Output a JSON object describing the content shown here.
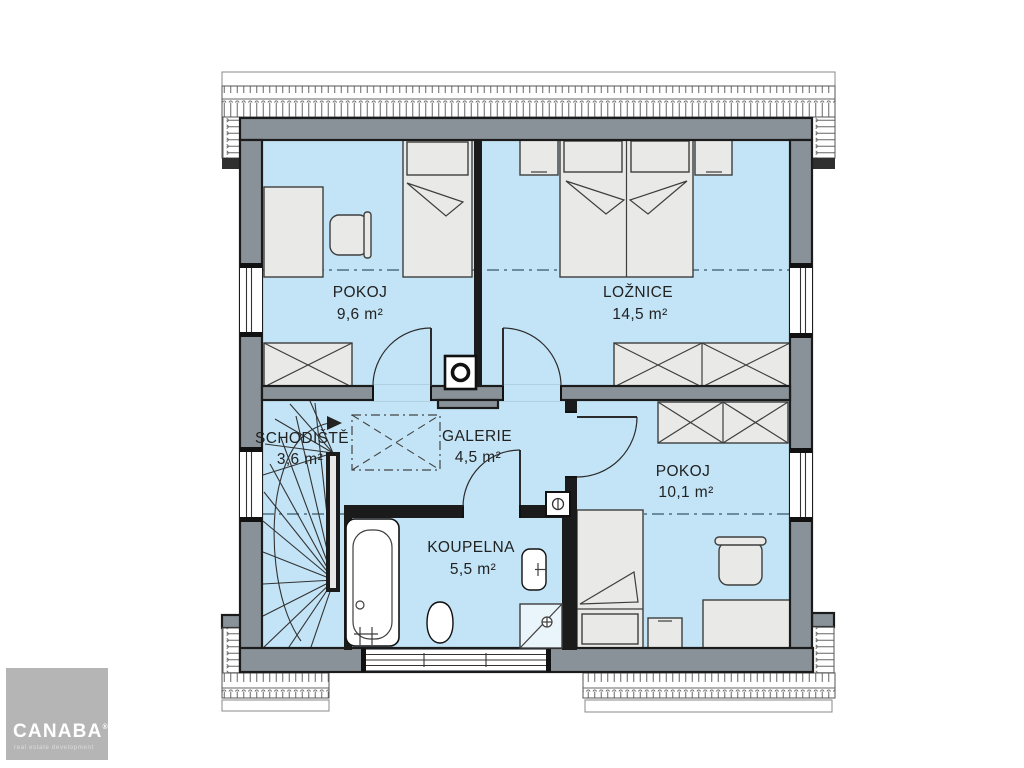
{
  "plan": {
    "rooms": [
      {
        "id": "pokoj-upper",
        "name": "POKOJ",
        "area": "9,6 m²"
      },
      {
        "id": "loznice",
        "name": "LOŽNICE",
        "area": "14,5 m²"
      },
      {
        "id": "schodiste",
        "name": "SCHODIŠTĚ",
        "area": "3,6 m²"
      },
      {
        "id": "galerie",
        "name": "GALERIE",
        "area": "4,5 m²"
      },
      {
        "id": "koupelna",
        "name": "KOUPELNA",
        "area": "5,5 m²"
      },
      {
        "id": "pokoj-lower",
        "name": "POKOJ",
        "area": "10,1 m²"
      }
    ],
    "colors": {
      "floor": "#c2e4f6",
      "wall": "#8a9299",
      "furniture": "#e9e9e8",
      "outline": "#1b1b1b",
      "attic_line": "#4d6e7e"
    }
  },
  "logo": {
    "brand": "CANABA",
    "registered": "®",
    "tagline": "real estate development",
    "background": "#b5b5b5"
  }
}
